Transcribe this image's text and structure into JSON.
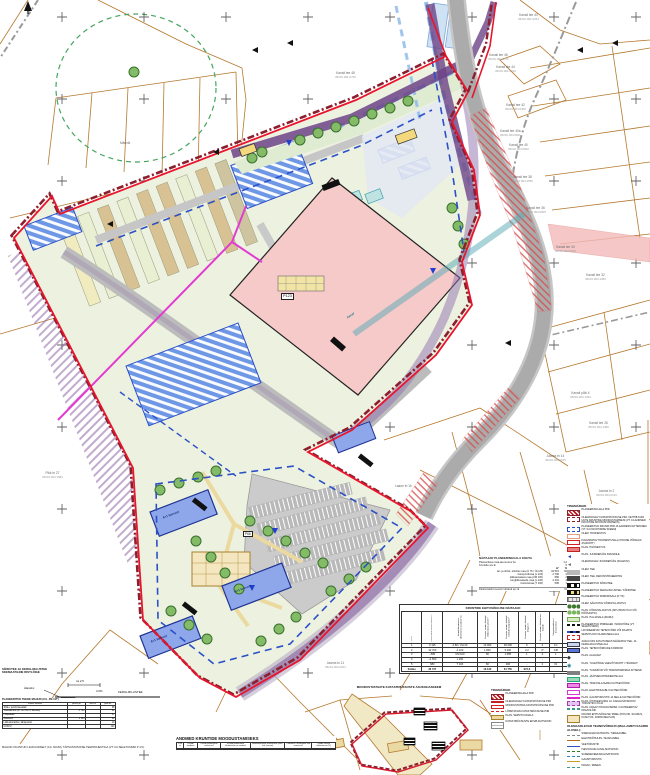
{
  "north": {
    "letter": "s"
  },
  "parcels": [
    {
      "name": "Kanali tee 43",
      "code": "35201:001:0264"
    },
    {
      "name": "Kanali tee 46",
      "code": "35201:001:0711"
    },
    {
      "name": "Kanali tee 44",
      "code": "35201:001:0910"
    },
    {
      "name": "Kanali tee 42",
      "code": "35201:004:0400"
    },
    {
      "name": "Kanali tee 40a",
      "code": "35201:004:0811"
    },
    {
      "name": "Kanali tee 40",
      "code": "35201:004:0810"
    },
    {
      "name": "Kanali tee 38",
      "code": "35201:004:1550"
    },
    {
      "name": "Kanali tee 36",
      "code": "35201:004:0905"
    },
    {
      "name": "Kanali tee 34",
      "code": "35201:004:0540"
    },
    {
      "name": "Kanali tee 32",
      "code": "35201:004:1350"
    },
    {
      "name": "Kanali tee 48",
      "code": "35201:001:0740"
    },
    {
      "name": "Kanali põik 4",
      "code": "35201:004:1060"
    },
    {
      "name": "Kanali tee 26",
      "code": "35201:004:1480"
    },
    {
      "name": "Jaama tn 14",
      "code": "35201:004:0075"
    },
    {
      "name": "Jaama tn 2",
      "code": "35201:004:0120"
    },
    {
      "name": "Jaama tn 11",
      "code": "35201:004:0201"
    },
    {
      "name": "Pikk tn 27",
      "code": "35201:004:1981"
    },
    {
      "name": "Laane tn 1b",
      "code": ""
    },
    {
      "name": "Männik",
      "code": ""
    }
  ],
  "map_labels": {
    "main_building": "P123",
    "pos_small": "P66",
    "canal": "kanal",
    "floors_a": "4+1 korrust",
    "floors_b": "4+1 korrust",
    "floors_c": "4+1 korrust"
  },
  "summary": {
    "title": "NÄITAJAD PLANEERINGUALA KOHTA",
    "rows": [
      {
        "label": "Planeeritava maa-ala suurus ha",
        "value": "1,2"
      },
      {
        "label": "Kruntide arv tk",
        "value": "5"
      }
    ],
    "usage_header": {
      "m2": "m²",
      "pct": "%"
    },
    "usage_rows": [
      {
        "label": "äri- ja ühisk. ehitiste maa (Ä 75 / ÜH 25)",
        "m2": "34 515",
        "pct": "92"
      },
      {
        "label": "transpordimaa (L 100)",
        "m2": "2 790",
        "pct": "3"
      },
      {
        "label": "üldkasutatava maa (ÜM 100)",
        "m2": "580",
        "pct": "2"
      },
      {
        "label": "kergliiklusteede maa (L 100)",
        "m2": "2 404",
        "pct": "2"
      },
      {
        "label": "tootmismaa (T 100)",
        "m2": "595",
        "pct": "1"
      }
    ],
    "footer": {
      "label": "Parkimiskohti suurim lubatud arv tk",
      "value": "31"
    }
  },
  "rights_table": {
    "title": "KRUNTIDE EHITUSÕIGUSE NÄITAJAD",
    "headers": [
      "Pos nr",
      "Planeeritud krundi suurus m²",
      "Krundi kasutamise sihtotstarve (osakaal %)",
      "Hoonete suurim lubatud ehitisealune pind m²",
      "Hoonete suurim lubatud suletud brutopind m²",
      "Hoonete suurim lubatud kõrgus m",
      "Hoonete suurim lubatud arv krundil",
      "Tulepüsivusklass / korruselisus",
      "Parkimiskohtade arv tk",
      "Märkused"
    ],
    "rows": [
      [
        "1",
        "9 115",
        "Ä 80 / ÜH 20",
        "13 000",
        "30 000",
        "6",
        "2",
        "1C",
        "123",
        "-"
      ],
      [
        "2",
        "10 700",
        "Ä 100",
        "1 800",
        "9 000",
        "2,2",
        "4*",
        "145",
        "71",
        "-"
      ],
      [
        "3",
        "~580",
        "ÜM 100",
        "60",
        "1 055",
        "1",
        "2",
        "1",
        "32",
        "-"
      ],
      [
        "4",
        "~2 500",
        "L 100",
        "-",
        "-",
        "-",
        "-",
        "-",
        "-",
        "-"
      ],
      [
        "5",
        "680",
        "T 100",
        "60",
        "200",
        "-",
        "2",
        "6J",
        "-",
        "-"
      ]
    ],
    "total": [
      "Kokku",
      "36 737",
      "",
      "16 120",
      "61 755",
      "972,6",
      "",
      "",
      "693",
      ""
    ]
  },
  "formation_table": {
    "title": "ANDMED KRUNTIDE MOODUSTAMISEKS",
    "headers": [
      "Pos nr",
      "Krundi aadress",
      "Krundi planeeritud suurus m²",
      "Krundi planeeritud sihtotstarve ja osakaal",
      "Moodustatakse kinnistutest (nimi / kat. tunnus)",
      "Liidetava / lahutatava osa suurus m²",
      "Osade senine sihtotstarve (%)"
    ]
  },
  "balance_table": {
    "title": "PLANEERITUD TEEDE MAHUD (CA. JM / M²)",
    "headers": [
      "Teeosa nimetus",
      "pikkus jm",
      "laius m",
      "pind m²"
    ],
    "rows": [
      [
        "Sõidu- ja kõnniteealad",
        "",
        "",
        "38"
      ],
      [
        "Teekatendid (sh. ca 700 m² killustik)",
        "5 710",
        "",
        "21"
      ],
      [
        "Haljasalad",
        "",
        "",
        "17"
      ],
      [
        "Äärekivid",
        "1 113",
        "",
        "32"
      ],
      [
        "Liikluskorraldus, tähispostid",
        "",
        "",
        "10"
      ],
      [
        "KOKKU",
        "",
        "",
        "124"
      ]
    ]
  },
  "balance_note": "MAHUD ON ANTUD LIGIKAUDSELT (CA. M²/JM), TÄPSUSTATAKSE TEEPROJEKTIGA (VT. KA SELETUSKIRI P 4.5).",
  "section": {
    "heading1": "SÕIDUTEE JA KERGLIIKLUSTEE",
    "heading2": "SKEMAATILINE RISTLÕIGE",
    "label": "KERGLIIKLUSTEE",
    "edge_label": "Äärekivi",
    "dim_label": "ca 2,5",
    "slope_label": "i=2%"
  },
  "inset": {
    "title": "MOODUSTATAVATE KATASTRIÜKSUSTE ASUKOH​ASKEEM"
  },
  "legend": {
    "title": "TINGMÄRGID",
    "items": [
      {
        "type": "sw-plb",
        "text": "PLANEERINGUALA PIIR"
      },
      {
        "type": "sw-cad",
        "text": "OLEMASOLEV KATASTRIÜKSUSE PIIR, KEHTIB KUNI UUTE KRUNTIDE MOODUSTAMISENI (VT. KA ANDMED KRUNTIDE MOODUSTAMISEKS)"
      },
      {
        "type": "sw-new",
        "text": "PLANEERITUD KRUNDI PIIR JA AADRESSI ETTEPANEK (VT. KA KRUNTIMISE SKEEM)"
      },
      {
        "type": "sw-bex",
        "text": "OLEM. HOONESTUS"
      },
      {
        "type": "sw-bzone",
        "text": "KAVANDATAV HOONESTUSALA (HOONE VÕIMALIK ASUKOHT)"
      },
      {
        "type": "sw-bplan",
        "text": "PLAN. HOONESTUS"
      },
      {
        "type": "sw-accp",
        "text": "PLAN. JUURDEPÄÄS KRUNDILE"
      },
      {
        "type": "sw-acce",
        "text": "OLEMASOLEV JUURDEPÄÄS (SULETAV)"
      },
      {
        "type": "sw-rde",
        "text": "OLEM. TEE"
      },
      {
        "type": "sw-rdr",
        "text": "OLEM. TEE, REKONSTRUEERITAV"
      },
      {
        "type": "sw-rdp",
        "text": "PLANEERITUD SÕIDUTEE"
      },
      {
        "type": "sw-rdl",
        "text": "PLANEERITUD KERGLIIKLUSTEE / KÕNNITEE"
      },
      {
        "type": "sw-park",
        "text": "PLANEERITUD PARKIMISALA (P, TK)"
      },
      {
        "type": "sw-gre",
        "text": "OLEM. SÄILITATAV KÕRGHALJASTUS"
      },
      {
        "type": "sw-grp",
        "text": "PLAN. KÕRGHALJASTUS (ISTUTATAV PUU VÕI PÕÕSASTIK)"
      },
      {
        "type": "sw-lawn",
        "text": "PLAN. HALJASALA (MURU)"
      },
      {
        "type": "sw-noise",
        "text": "PLANEERITUD PIIRDEAED / MÜRATÕKE (VT. SELETUSKIRI)"
      },
      {
        "type": "sw-likv",
        "text": "LIKVIDEERITAV TEHNOVÕRK VÕI RAJATIS"
      },
      {
        "type": "sw-serv",
        "text": "SERVITUUDI VAJADUSEGA ALA"
      },
      {
        "type": "sw-publ",
        "text": "AVALIKUKS KASUTUSEKS MÄÄRATAV TEE- JA KERGLIIKLUSTEE ALA"
      },
      {
        "type": "sw-corr",
        "text": "PLAN. TEHNOVÕRKUDE KORIDOR"
      },
      {
        "type": "sw-sub",
        "text": "PLAN. ALAJAAM"
      },
      {
        "type": "sw-pump",
        "text": "PLAN. TULETÕRJE VEEVÕTUKOHT / HÜDRANT"
      },
      {
        "type": "sw-wall",
        "text": "PLAN. TUGIMÜÜR VÕI TRANSPORDIMAA KITSEND"
      },
      {
        "type": "sw-waste",
        "text": "PLAN. JÄÄTMEKONTEINERITE ALA"
      },
      {
        "type": "sw-tpz",
        "text": "PLAN. TRAFOALAJAAMA KAITSEVÖÖND"
      },
      {
        "type": "sw-elz",
        "text": "PLAN. ELEKTRIKAABLI KAITSEVÖÖND"
      },
      {
        "type": "sw-gas",
        "text": "PLAN. GAASITORUSTIK JA SELLE KAITSEVÖÖND"
      },
      {
        "type": "sw-wkz",
        "text": "PLAN. ÜHISVEEVÄRGI JA -KANALISATSIOONI TORUSTIKU KUJA"
      },
      {
        "type": "sw-ditch",
        "text": "PLAN. KRAAVI HOOLDUSRIBA / LIKVIDEERITAV KRAAVILÕIK"
      },
      {
        "type": "sw-tbl",
        "text": "KRUNDI EHITUSÕIGUSE TABEL (POS NR, SUURUS, KASUTUS, KORRUSELISUS)"
      }
    ],
    "utilities_title": "OLEMASOLEVAD TEHNOVÕRGUD (MAA-AMETI KAARDI ALUSEL):",
    "utilities": [
      {
        "type": "u-side",
        "text": "SIDEKANALISATSIOON / SIDEKAABEL"
      },
      {
        "type": "u-el",
        "text": "ELEKTRIÕHULIIN / MAAKAABEL"
      },
      {
        "type": "u-vesi",
        "text": "VEETORUSTIK"
      },
      {
        "type": "u-kan",
        "text": "ISEVOOLNE KANALISATSIOON"
      },
      {
        "type": "u-sade",
        "text": "SADEMEVEEKANALISATSIOON"
      },
      {
        "type": "u-gaas",
        "text": "GAASITORUSTIK"
      },
      {
        "type": "u-kraav",
        "text": "KRAAV / DREEN"
      }
    ]
  },
  "mini_legend": {
    "title": "TINGMÄRGID",
    "items": [
      {
        "type": "sw-plb",
        "text": "PLANEERINGUALA PIIR"
      },
      {
        "type": "sw-mex",
        "text": "OLEMASOLEV KATASTRIÜKSUSE PIIR"
      },
      {
        "type": "sw-mmo",
        "text": "MOODUSTATAVA KATASTRIÜKSUSE PIIR"
      },
      {
        "type": "sw-maj",
        "text": "LÕPETATAVA KATASTRIÜKSUSE PIIR"
      },
      {
        "type": "sw-mserv",
        "text": "PLAN. SERVITUUDIALA"
      },
      {
        "type": "sw-mbox",
        "text": "KATASTRIÜKSUSTE EKSPLIKATSIOON"
      }
    ]
  }
}
